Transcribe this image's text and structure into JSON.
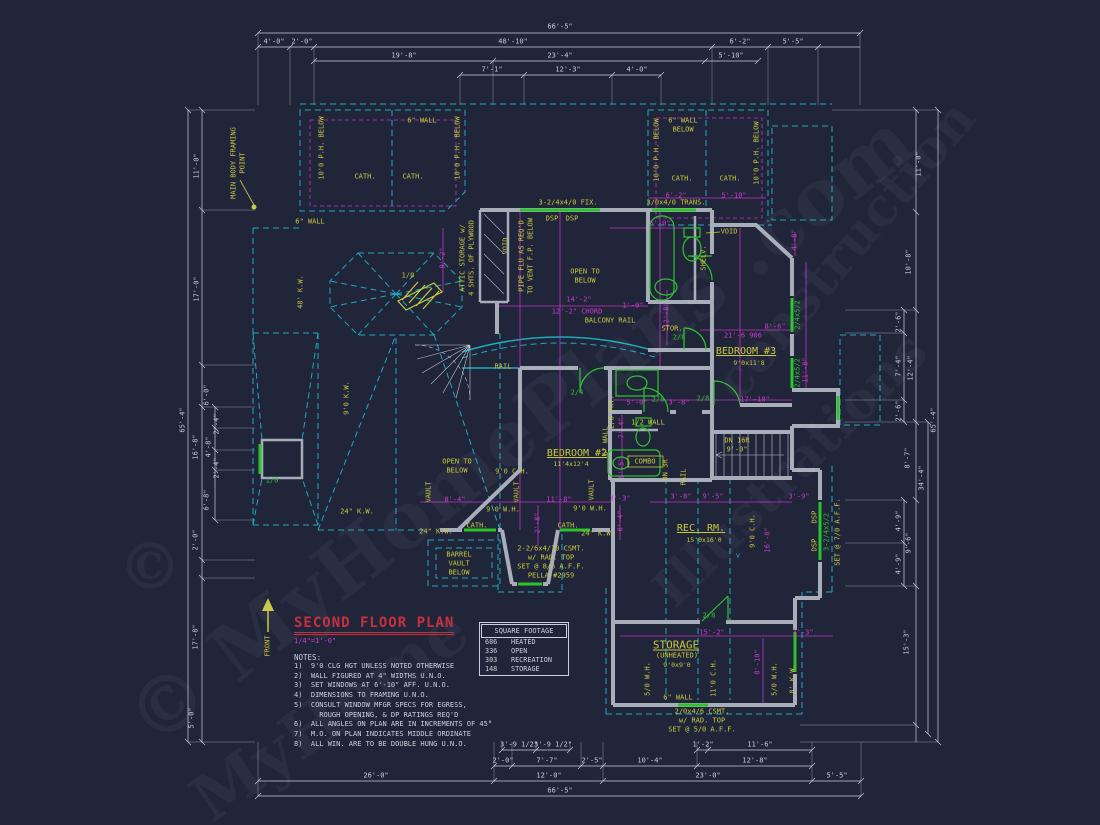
{
  "sheet": {
    "title": "SECOND FLOOR PLAN",
    "scale": "1/4\"=1'-0\"",
    "notes_heading": "NOTES:",
    "notes": [
      "1)  9'0 CLG HGT UNLESS NOTED OTHERWISE",
      "2)  WALL FIGURED AT 4\" WIDTHS U.N.O.",
      "3)  SET WINDOWS AT 6'-10\" AFF. U.N.O.",
      "4)  DIMENSIONS TO FRAMING U.N.O.",
      "5)  CONSULT WINDOW MFGR SPECS FOR EGRESS,",
      "      ROUGH OPENING, & DP RATINGS REQ'D",
      "6)  ALL ANGLES ON PLAN ARE IN INCREMENTS OF 45°",
      "7)  M.O. ON PLAN INDICATES MIDDLE ORDINATE",
      "8)  ALL WIN. ARE TO BE DOUBLE HUNG U.N.O."
    ]
  },
  "square_footage": {
    "header": "SQUARE FOOTAGE",
    "rows": [
      [
        "686",
        "HEATED"
      ],
      [
        "336",
        "OPEN"
      ],
      [
        "303",
        "RECREATION"
      ],
      [
        "148",
        "STORAGE"
      ]
    ]
  },
  "watermarks": [
    {
      "t": "© MyHomePlans .com",
      "x": 520,
      "y": 430,
      "rot": -38,
      "fs": 78
    },
    {
      "t": "construction",
      "x": 845,
      "y": 250,
      "rot": -50,
      "fs": 52
    },
    {
      "t": "Illustrations",
      "x": 790,
      "y": 470,
      "rot": -45,
      "fs": 52
    },
    {
      "t": "MyHome",
      "x": 330,
      "y": 715,
      "rot": -35,
      "fs": 64
    },
    {
      "t": "©",
      "x": 150,
      "y": 567,
      "rot": 0,
      "fs": 64
    }
  ],
  "annotations": {
    "dims_top": [
      {
        "t": "66'-5\"",
        "x": 560,
        "y": 27
      },
      {
        "t": "4'-0\"",
        "x": 274,
        "y": 42
      },
      {
        "t": "2'-0\"",
        "x": 302,
        "y": 42
      },
      {
        "t": "48'-10\"",
        "x": 513,
        "y": 42
      },
      {
        "t": "6'-2\"",
        "x": 740,
        "y": 42
      },
      {
        "t": "5'-5\"",
        "x": 793,
        "y": 42
      },
      {
        "t": "19'-8\"",
        "x": 404,
        "y": 56
      },
      {
        "t": "23'-4\"",
        "x": 560,
        "y": 56
      },
      {
        "t": "5'-10\"",
        "x": 731,
        "y": 56
      },
      {
        "t": "7'-1\"",
        "x": 492,
        "y": 70
      },
      {
        "t": "12'-3\"",
        "x": 568,
        "y": 70
      },
      {
        "t": "4'-0\"",
        "x": 637,
        "y": 70
      }
    ],
    "dims_bottom": [
      {
        "t": "3'-9 1/2\"",
        "x": 519,
        "y": 745
      },
      {
        "t": "3'-9 1/2\"",
        "x": 553,
        "y": 745
      },
      {
        "t": "1'-2\"",
        "x": 703,
        "y": 745
      },
      {
        "t": "11'-6\"",
        "x": 760,
        "y": 745
      },
      {
        "t": "2'-0\"",
        "x": 503,
        "y": 761
      },
      {
        "t": "7'-7\"",
        "x": 547,
        "y": 761
      },
      {
        "t": "2'-5\"",
        "x": 592,
        "y": 761
      },
      {
        "t": "10'-4\"",
        "x": 650,
        "y": 761
      },
      {
        "t": "12'-8\"",
        "x": 755,
        "y": 761
      },
      {
        "t": "26'-0\"",
        "x": 376,
        "y": 776
      },
      {
        "t": "12'-0\"",
        "x": 549,
        "y": 776
      },
      {
        "t": "23'-0\"",
        "x": 708,
        "y": 776
      },
      {
        "t": "5'-5\"",
        "x": 837,
        "y": 776
      },
      {
        "t": "66'-5\"",
        "x": 560,
        "y": 791
      }
    ],
    "dims_left": [
      {
        "t": "11'-0\"",
        "x": 197,
        "y": 166,
        "r": 1
      },
      {
        "t": "17'-0\"",
        "x": 197,
        "y": 289,
        "r": 1
      },
      {
        "t": "6'-0\"",
        "x": 207,
        "y": 395,
        "r": 1
      },
      {
        "t": "16'-8\"",
        "x": 196,
        "y": 447,
        "r": 1
      },
      {
        "t": "2'-4\"",
        "x": 217,
        "y": 424,
        "r": 1
      },
      {
        "t": "4'-8\"",
        "x": 209,
        "y": 447,
        "r": 1
      },
      {
        "t": "2'-4\"",
        "x": 217,
        "y": 468,
        "r": 1
      },
      {
        "t": "6'-8\"",
        "x": 207,
        "y": 500,
        "r": 1
      },
      {
        "t": "2'-0\"",
        "x": 196,
        "y": 540,
        "r": 1
      },
      {
        "t": "17'-8\"",
        "x": 196,
        "y": 637,
        "r": 1
      },
      {
        "t": "65'-4\"",
        "x": 183,
        "y": 420,
        "r": 1
      },
      {
        "t": "5'-0\"",
        "x": 192,
        "y": 718,
        "r": 1
      }
    ],
    "dims_right": [
      {
        "t": "11'-0\"",
        "x": 919,
        "y": 164,
        "r": 1
      },
      {
        "t": "10'-8\"",
        "x": 909,
        "y": 262,
        "r": 1
      },
      {
        "t": "2'-6\"",
        "x": 899,
        "y": 322,
        "r": 1
      },
      {
        "t": "7'-4\"",
        "x": 899,
        "y": 366,
        "r": 1
      },
      {
        "t": "12'-4\"",
        "x": 911,
        "y": 368,
        "r": 1
      },
      {
        "t": "2'-6\"",
        "x": 899,
        "y": 411,
        "r": 1
      },
      {
        "t": "8'-7\"",
        "x": 908,
        "y": 458,
        "r": 1
      },
      {
        "t": "34'-4\"",
        "x": 922,
        "y": 478,
        "r": 1
      },
      {
        "t": "4'-9\"",
        "x": 899,
        "y": 521,
        "r": 1
      },
      {
        "t": "9'-6\"",
        "x": 909,
        "y": 543,
        "r": 1
      },
      {
        "t": "4'-9\"",
        "x": 899,
        "y": 564,
        "r": 1
      },
      {
        "t": "15'-3\"",
        "x": 907,
        "y": 642,
        "r": 1
      },
      {
        "t": "65'-4\"",
        "x": 934,
        "y": 420,
        "r": 1
      }
    ],
    "dims_interior": [
      {
        "t": "6'-2\"",
        "x": 676,
        "y": 196,
        "c": "m"
      },
      {
        "t": "5'-10\"",
        "x": 734,
        "y": 196,
        "c": "m"
      },
      {
        "t": "5'-0\"",
        "x": 660,
        "y": 224,
        "c": "m"
      },
      {
        "t": "4'-8\"",
        "x": 795,
        "y": 240,
        "c": "m",
        "r": 1
      },
      {
        "t": "9'-2\"",
        "x": 443,
        "y": 258,
        "c": "m",
        "r": 1
      },
      {
        "t": "12'-8\"",
        "x": 667,
        "y": 315,
        "c": "m",
        "r": 1
      },
      {
        "t": "1'-0\"",
        "x": 633,
        "y": 306,
        "c": "m"
      },
      {
        "t": "14'-2\"",
        "x": 579,
        "y": 300,
        "c": "m"
      },
      {
        "t": "12'-2\" CHORD",
        "x": 577,
        "y": 312,
        "c": "m"
      },
      {
        "t": "21'-6 906",
        "x": 743,
        "y": 336,
        "c": "m"
      },
      {
        "t": "8'-6\"",
        "x": 775,
        "y": 327,
        "c": "m"
      },
      {
        "t": "11'-8\"",
        "x": 806,
        "y": 370,
        "c": "m",
        "r": 1
      },
      {
        "t": "5'-0\"",
        "x": 637,
        "y": 403,
        "c": "m"
      },
      {
        "t": "3'-8\"",
        "x": 679,
        "y": 403,
        "c": "m"
      },
      {
        "t": "17'-10\"",
        "x": 755,
        "y": 400,
        "c": "m"
      },
      {
        "t": "7'-4\"",
        "x": 622,
        "y": 428,
        "c": "m",
        "r": 1
      },
      {
        "t": "5'-5\"",
        "x": 622,
        "y": 468,
        "c": "m",
        "r": 1
      },
      {
        "t": "3'-8\"",
        "x": 681,
        "y": 497,
        "c": "m"
      },
      {
        "t": "9'-5\"",
        "x": 713,
        "y": 497,
        "c": "m"
      },
      {
        "t": "8'-4\"",
        "x": 455,
        "y": 500,
        "c": "m"
      },
      {
        "t": "11'-8\"",
        "x": 559,
        "y": 500,
        "c": "m"
      },
      {
        "t": "2'-8\"",
        "x": 538,
        "y": 523,
        "c": "m",
        "r": 1
      },
      {
        "t": "3'-3\"",
        "x": 620,
        "y": 499,
        "c": "m"
      },
      {
        "t": "6'-4\"",
        "x": 621,
        "y": 521,
        "c": "m",
        "r": 1
      },
      {
        "t": "16'-8\"",
        "x": 768,
        "y": 540,
        "c": "m",
        "r": 1
      },
      {
        "t": "3'-9\"",
        "x": 799,
        "y": 497,
        "c": "m"
      },
      {
        "t": "15'-2\"",
        "x": 712,
        "y": 633,
        "c": "m"
      },
      {
        "t": "3'-3\"",
        "x": 803,
        "y": 633,
        "c": "m"
      },
      {
        "t": "8'-10\"",
        "x": 758,
        "y": 662,
        "c": "m",
        "r": 1
      }
    ],
    "room_labels": [
      {
        "t": "BEDROOM #3",
        "x": 746,
        "y": 352,
        "c": "y",
        "fs": 10,
        "u": 1
      },
      {
        "t": "9'0x11'8",
        "x": 749,
        "y": 363,
        "c": "y",
        "fs": 6.5
      },
      {
        "t": "BEDROOM #2",
        "x": 577,
        "y": 454,
        "c": "y",
        "fs": 10,
        "u": 1
      },
      {
        "t": "11'4x12'4",
        "x": 571,
        "y": 464,
        "c": "y",
        "fs": 6.5
      },
      {
        "t": "REC. RM.",
        "x": 701,
        "y": 529,
        "c": "y",
        "fs": 10,
        "u": 1
      },
      {
        "t": "15'0x16'0",
        "x": 704,
        "y": 540,
        "c": "y",
        "fs": 6.5
      },
      {
        "t": "STORAGE",
        "x": 676,
        "y": 645,
        "c": "y",
        "fs": 11,
        "u": 1
      },
      {
        "t": "(UNHEATED)",
        "x": 677,
        "y": 656,
        "c": "y"
      },
      {
        "t": "9'0x9'0",
        "x": 677,
        "y": 665,
        "c": "y",
        "fs": 6.5
      },
      {
        "t": "STOR.",
        "x": 672,
        "y": 329,
        "c": "y"
      },
      {
        "t": "COMBO",
        "x": 645,
        "y": 462,
        "c": "y"
      },
      {
        "t": "OPEN TO",
        "x": 585,
        "y": 272,
        "c": "y"
      },
      {
        "t": "BELOW",
        "x": 585,
        "y": 281,
        "c": "y"
      },
      {
        "t": "OPEN TO",
        "x": 457,
        "y": 462,
        "c": "y"
      },
      {
        "t": "BELOW",
        "x": 457,
        "y": 471,
        "c": "y"
      },
      {
        "t": "BALCONY RAIL",
        "x": 610,
        "y": 321,
        "c": "y"
      },
      {
        "t": "RAIL",
        "x": 503,
        "y": 367,
        "c": "y"
      },
      {
        "t": "RAIL",
        "x": 684,
        "y": 477,
        "c": "y",
        "r": 1
      },
      {
        "t": "DN 16R",
        "x": 737,
        "y": 441,
        "c": "y"
      },
      {
        "t": "9'-0\"",
        "x": 737,
        "y": 450,
        "c": "y"
      },
      {
        "t": "BARREL",
        "x": 459,
        "y": 555,
        "c": "y"
      },
      {
        "t": "VAULT",
        "x": 459,
        "y": 564,
        "c": "y"
      },
      {
        "t": "BELOW",
        "x": 459,
        "y": 573,
        "c": "y"
      },
      {
        "t": "VAULT",
        "x": 429,
        "y": 492,
        "c": "y",
        "r": 1
      },
      {
        "t": "VAULT",
        "x": 517,
        "y": 492,
        "c": "y",
        "r": 1
      },
      {
        "t": "VAULT",
        "x": 592,
        "y": 490,
        "c": "y",
        "r": 1
      },
      {
        "t": "CATH.",
        "x": 365,
        "y": 177,
        "c": "y"
      },
      {
        "t": "CATH.",
        "x": 413,
        "y": 177,
        "c": "y"
      },
      {
        "t": "CATH.",
        "x": 682,
        "y": 179,
        "c": "y"
      },
      {
        "t": "CATH.",
        "x": 730,
        "y": 179,
        "c": "y"
      },
      {
        "t": "CATH.",
        "x": 477,
        "y": 526,
        "c": "y"
      },
      {
        "t": "CATH.",
        "x": 568,
        "y": 526,
        "c": "y"
      },
      {
        "t": "1/2 WALL",
        "x": 648,
        "y": 423,
        "c": "y"
      },
      {
        "t": "2/8 PKT.",
        "x": 612,
        "y": 412,
        "c": "y",
        "r": 1
      },
      {
        "t": "6\" WALL",
        "x": 606,
        "y": 441,
        "c": "y",
        "r": 1
      },
      {
        "t": "DN 3R",
        "x": 666,
        "y": 470,
        "c": "y",
        "r": 1
      },
      {
        "t": "SHELV.",
        "x": 704,
        "y": 258,
        "c": "y",
        "r": 1
      },
      {
        "t": "VOID",
        "x": 506,
        "y": 246,
        "c": "y",
        "r": 1
      },
      {
        "t": "VOID",
        "x": 729,
        "y": 232,
        "c": "y"
      },
      {
        "t": "PIPE FLU AS REQ'D",
        "x": 522,
        "y": 256,
        "c": "y",
        "r": 1
      },
      {
        "t": "TO VENT F.P. BELOW",
        "x": 531,
        "y": 256,
        "c": "y",
        "r": 1
      },
      {
        "t": "ATTIC STORAGE w/",
        "x": 463,
        "y": 258,
        "c": "y",
        "r": 1
      },
      {
        "t": "4 SHTS. OF PLYWOOD",
        "x": 472,
        "y": 258,
        "c": "y",
        "r": 1
      },
      {
        "t": "MAIN BODY FRAMING",
        "x": 234,
        "y": 163,
        "c": "y",
        "r": 1
      },
      {
        "t": "POINT",
        "x": 243,
        "y": 163,
        "c": "y",
        "r": 1
      },
      {
        "t": "10'0 P.H. BELOW",
        "x": 322,
        "y": 148,
        "c": "y",
        "r": 1
      },
      {
        "t": "10'0 P.H. BELOW",
        "x": 458,
        "y": 148,
        "c": "y",
        "r": 1
      },
      {
        "t": "10'0 P.H. BELOW",
        "x": 657,
        "y": 150,
        "c": "y",
        "r": 1
      },
      {
        "t": "10'0 P.H. BELOW",
        "x": 757,
        "y": 153,
        "c": "y",
        "r": 1
      },
      {
        "t": "6\" WALL",
        "x": 683,
        "y": 121,
        "c": "y"
      },
      {
        "t": "BELOW",
        "x": 683,
        "y": 130,
        "c": "y"
      },
      {
        "t": "6\" WALL",
        "x": 310,
        "y": 222,
        "c": "y"
      },
      {
        "t": "6\" WALL",
        "x": 422,
        "y": 121,
        "c": "y"
      },
      {
        "t": "6\" WALL",
        "x": 678,
        "y": 698,
        "c": "y"
      },
      {
        "t": "48' K.W.",
        "x": 301,
        "y": 292,
        "c": "y",
        "r": 1
      },
      {
        "t": "9'0 K.W.",
        "x": 347,
        "y": 398,
        "c": "y",
        "r": 1
      },
      {
        "t": "24\" K.W.",
        "x": 357,
        "y": 512,
        "c": "y"
      },
      {
        "t": "24\" K.W.",
        "x": 436,
        "y": 532,
        "c": "y"
      },
      {
        "t": "24\" K.W.",
        "x": 598,
        "y": 534,
        "c": "y"
      },
      {
        "t": "9'0 C.H.",
        "x": 512,
        "y": 472,
        "c": "y"
      },
      {
        "t": "9'0 C.H.",
        "x": 753,
        "y": 531,
        "c": "y",
        "r": 1
      },
      {
        "t": "9'0 W.H.",
        "x": 503,
        "y": 510,
        "c": "y"
      },
      {
        "t": "9'0 W.H.",
        "x": 590,
        "y": 509,
        "c": "y"
      },
      {
        "t": "5/0 W.H.",
        "x": 648,
        "y": 679,
        "c": "y",
        "r": 1
      },
      {
        "t": "5/0 W.H.",
        "x": 775,
        "y": 679,
        "c": "y",
        "r": 1
      },
      {
        "t": "11'0 C.H.",
        "x": 714,
        "y": 678,
        "c": "y",
        "r": 1
      },
      {
        "t": "8' K.W.",
        "x": 793,
        "y": 679,
        "c": "y",
        "r": 1
      },
      {
        "t": "3-2/4x4/0 FIX.",
        "x": 568,
        "y": 203,
        "c": "y"
      },
      {
        "t": "DSP",
        "x": 552,
        "y": 219,
        "c": "y"
      },
      {
        "t": "DSP",
        "x": 572,
        "y": 219,
        "c": "y"
      },
      {
        "t": "3/0x4/0 TRANS.",
        "x": 676,
        "y": 203,
        "c": "y"
      },
      {
        "t": "2-2/6x4/10 CSMT.",
        "x": 551,
        "y": 549,
        "c": "y"
      },
      {
        "t": "w/ RAD. TOP",
        "x": 551,
        "y": 558,
        "c": "y"
      },
      {
        "t": "SET @ 8/6 A.F.F.",
        "x": 551,
        "y": 567,
        "c": "y"
      },
      {
        "t": "PELLA #2959",
        "x": 551,
        "y": 576,
        "c": "y"
      },
      {
        "t": "2/0x4/6 CSMT.",
        "x": 702,
        "y": 712,
        "c": "y"
      },
      {
        "t": "w/ RAD. TOP",
        "x": 702,
        "y": 721,
        "c": "y"
      },
      {
        "t": "SET @ 5/0 A.F.F.",
        "x": 702,
        "y": 730,
        "c": "y"
      },
      {
        "t": "SET @ 7/0 A.F.F.",
        "x": 838,
        "y": 532,
        "c": "y",
        "r": 1
      },
      {
        "t": "DSP",
        "x": 815,
        "y": 517,
        "c": "y",
        "r": 1
      },
      {
        "t": "DSP",
        "x": 815,
        "y": 545,
        "c": "y",
        "r": 1
      },
      {
        "t": "FRONT",
        "x": 268,
        "y": 646,
        "c": "y",
        "r": 1
      },
      {
        "t": "1/0",
        "x": 408,
        "y": 276,
        "c": "y"
      }
    ],
    "tags": [
      {
        "t": "2/8",
        "x": 703,
        "y": 399,
        "c": "g"
      },
      {
        "t": "2/8",
        "x": 658,
        "y": 400,
        "c": "g"
      },
      {
        "t": "2/8",
        "x": 679,
        "y": 338,
        "c": "g"
      },
      {
        "t": "2/8",
        "x": 709,
        "y": 616,
        "c": "g"
      },
      {
        "t": "2/4",
        "x": 577,
        "y": 393,
        "c": "g"
      },
      {
        "t": "1/0",
        "x": 272,
        "y": 481,
        "c": "g"
      },
      {
        "t": "2/4x5/2",
        "x": 798,
        "y": 315,
        "c": "g",
        "r": 1
      },
      {
        "t": "2/4x5/2",
        "x": 798,
        "y": 373,
        "c": "g",
        "r": 1
      },
      {
        "t": "3-2/4x5/2",
        "x": 827,
        "y": 532,
        "c": "g",
        "r": 1
      },
      {
        "t": "v",
        "x": 738,
        "y": 556,
        "c": "c"
      }
    ]
  }
}
